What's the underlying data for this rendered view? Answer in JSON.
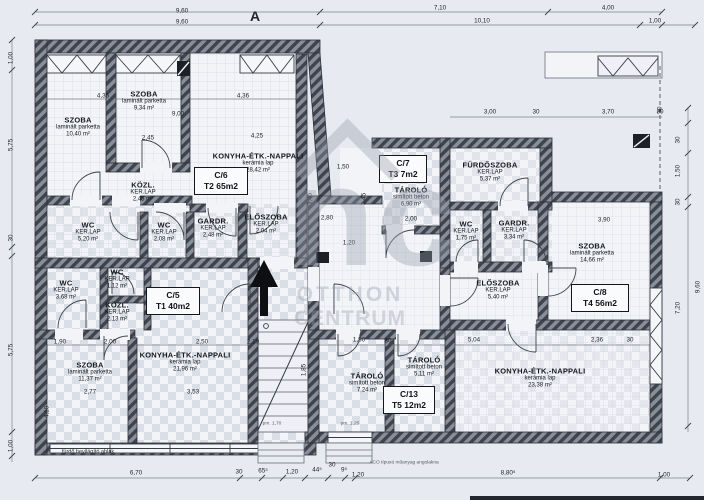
{
  "section_marker": "A",
  "watermark": {
    "logo": "nc",
    "line1": "OTTHON",
    "line2": "CENTRUM"
  },
  "units": [
    {
      "id": "C/5",
      "type": "T1 40m2"
    },
    {
      "id": "C/6",
      "type": "T2 65m2"
    },
    {
      "id": "C/7",
      "type": "T3 7m2"
    },
    {
      "id": "C/8",
      "type": "T4 56m2"
    },
    {
      "id": "C/13",
      "type": "T5 12m2"
    }
  ],
  "rooms": [
    {
      "name": "SZOBA",
      "finish": "laminált parketta",
      "area": "10,40 m²"
    },
    {
      "name": "SZOBA",
      "finish": "laminált parketta",
      "area": "9,34 m²"
    },
    {
      "name": "KONYHA-ÉTK.-NAPPALI",
      "finish": "kerámia lap",
      "area": "28,42 m²"
    },
    {
      "name": "KÖZL.",
      "finish": "KER.LAP",
      "area": "2,45 m²"
    },
    {
      "name": "WC",
      "finish": "KER.LAP",
      "area": "5,20 m²"
    },
    {
      "name": "WC",
      "finish": "KER.LAP",
      "area": "2,08 m²"
    },
    {
      "name": "GARDR.",
      "finish": "KER.LAP",
      "area": "2,48 m²"
    },
    {
      "name": "ELŐSZOBA",
      "finish": "KER.LAP",
      "area": "2,04 m²"
    },
    {
      "name": "WC",
      "finish": "KER.LAP",
      "area": "3,68 m²"
    },
    {
      "name": "WC",
      "finish": "KER.LAP",
      "area": "1,12 m²"
    },
    {
      "name": "KÖZL.",
      "finish": "KER.LAP",
      "area": "2,13 m²"
    },
    {
      "name": "KONYHA-ÉTK.-NAPPALI",
      "finish": "kerámia lap",
      "area": "21,96 m²"
    },
    {
      "name": "SZOBA",
      "finish": "laminált parketta",
      "area": "11,37 m²"
    },
    {
      "name": "TÁROLÓ",
      "finish": "simított beton",
      "area": "6,90 m²"
    },
    {
      "name": "FÜRDŐSZOBA",
      "finish": "KER.LAP",
      "area": "5,37 m²"
    },
    {
      "name": "WC",
      "finish": "KER.LAP",
      "area": "1,75 m²"
    },
    {
      "name": "GARDR.",
      "finish": "KER.LAP",
      "area": "3,34 m²"
    },
    {
      "name": "ELŐSZOBA",
      "finish": "KER.LAP",
      "area": "5,40 m²"
    },
    {
      "name": "SZOBA",
      "finish": "laminált parketta",
      "area": "14,66 m²"
    },
    {
      "name": "KONYHA-ÉTK.-NAPPALI",
      "finish": "kerámia lap",
      "area": "23,38 m²"
    },
    {
      "name": "TÁROLÓ",
      "finish": "simított beton",
      "area": "7,24 m²"
    },
    {
      "name": "TÁROLÓ",
      "finish": "simított beton",
      "area": "5,11 m²"
    }
  ],
  "dims": [
    "9,60",
    "7,10",
    "4,00",
    "9,60",
    "10,10",
    "1,00",
    "6,70",
    "30",
    "65⁵",
    "1,20",
    "44⁵",
    "30",
    "9⁵",
    "1,20",
    "8,80⁵",
    "1,00",
    "1,00",
    "5,75",
    "30",
    "5,75",
    "1,00",
    "30",
    "30",
    "1,50",
    "30",
    "7,20",
    "9,60",
    "4,35",
    "4,36",
    "9,00",
    "2,45",
    "4,25",
    "1,50",
    "3,45",
    "3,45",
    "2,80",
    "1,20",
    "2,00",
    "3,00",
    "3,70",
    "3,90",
    "5,04",
    "2,36",
    "1,80",
    "2,10",
    "1,85",
    "1,90",
    "2,00",
    "2,50",
    "3,53",
    "4,10",
    "2,77",
    "30",
    "30",
    "30",
    "30"
  ],
  "notes": {
    "window": "fürdő bevilágító ablak",
    "drain": "ACO típusú műanyag angolakna",
    "pm1": "pm. 1,70",
    "pm2": "pm. 1,25"
  }
}
